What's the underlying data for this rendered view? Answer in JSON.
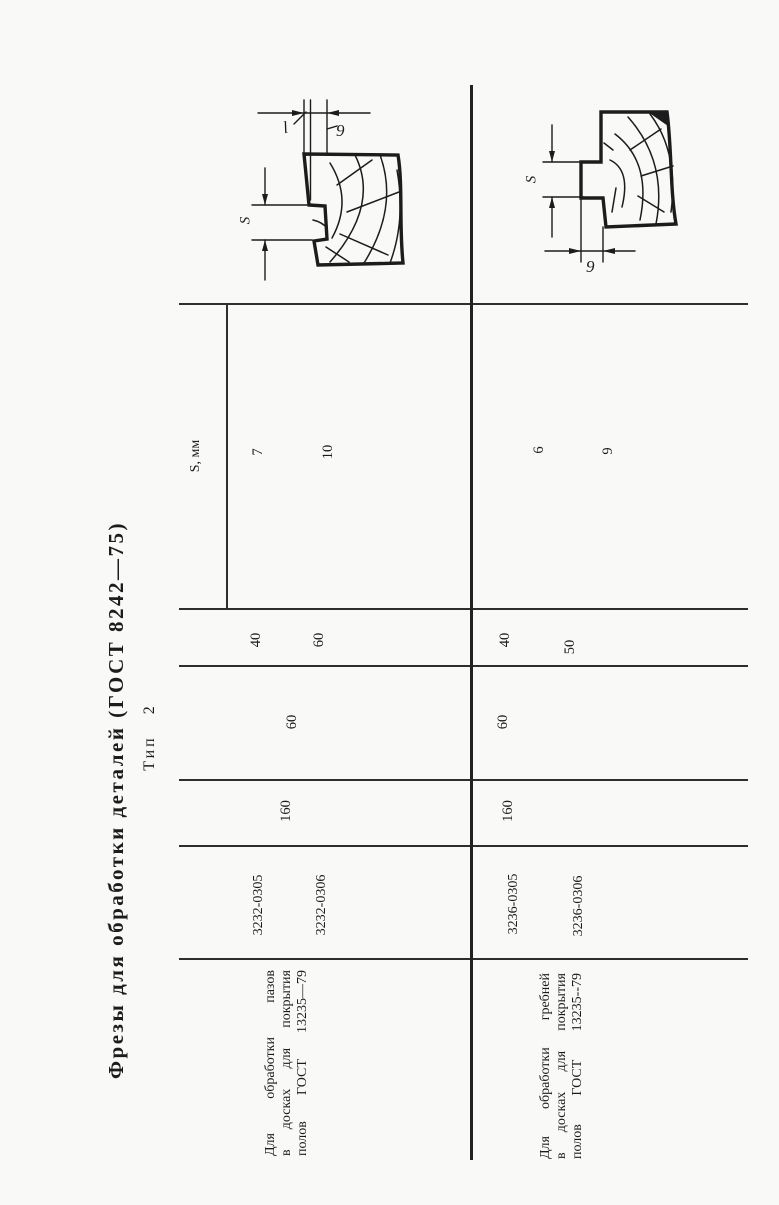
{
  "page": {
    "title": "Фрезы для обработки деталей (ГОСТ 8242—75)",
    "type_label": "Тип 2"
  },
  "table": {
    "s_header": "S, мм",
    "sections": [
      {
        "purpose_lines": [
          "Для обработки пазов",
          "в досках для покрытия",
          "полов ГОСТ 13235—79"
        ],
        "designations": [
          "3232-0305",
          "3232-0306"
        ],
        "diameter_value": "160",
        "bore_value": "60",
        "width_values": [
          "40",
          "60"
        ],
        "s_values": [
          "7",
          "10"
        ]
      },
      {
        "purpose_lines": [
          "Для обработки гребней",
          "в досках для покрытия",
          "полов ГОСТ 13235--79"
        ],
        "designations": [
          "3236-0305",
          "3236-0306"
        ],
        "diameter_value": "160",
        "bore_value": "60",
        "width_values": [
          "40",
          "50"
        ],
        "s_values": [
          "6",
          "9"
        ]
      }
    ]
  },
  "drawings": [
    {
      "name": "groove-profile-sketch",
      "s_label": "S",
      "l_label": "l",
      "b_label": "9"
    },
    {
      "name": "tongue-profile-sketch",
      "s_label": "S",
      "b_label": "9"
    }
  ],
  "colors": {
    "ink": "#1c1c1c",
    "paper": "#f9f9f7",
    "line": "#2e2e2e"
  }
}
